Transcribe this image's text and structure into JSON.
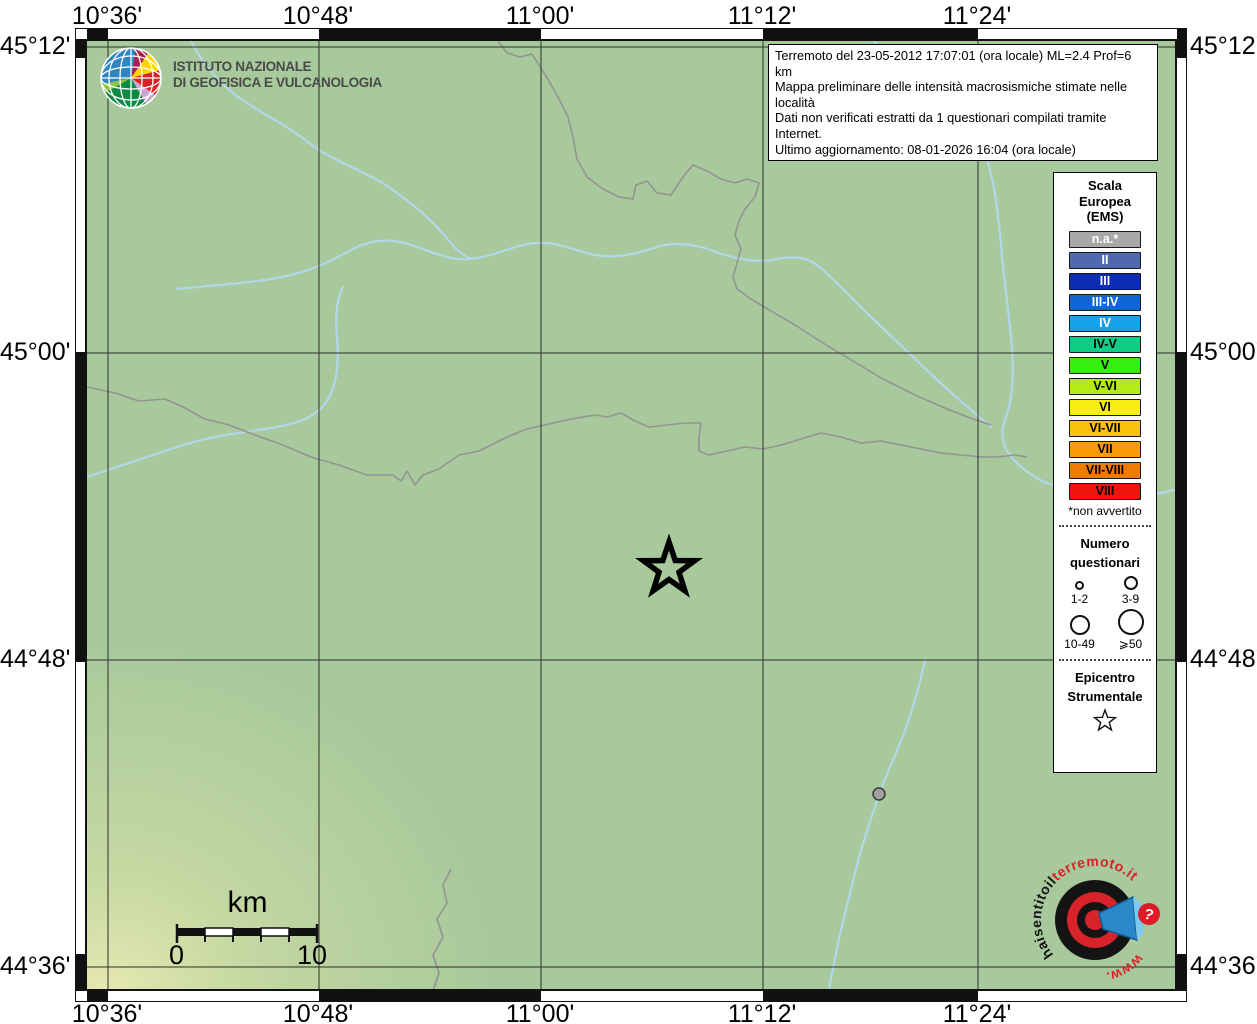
{
  "theme": {
    "map-green": "#a7c99b",
    "river-blue": "#b3d7e9",
    "boundary-gray": "#949494",
    "frame-black": "#111111",
    "band-white": "#ffffff",
    "legend-red": "#d8232a",
    "ingv-blue": "#2e86c1"
  },
  "axes": {
    "lon": [
      "10°36'",
      "10°48'",
      "11°00'",
      "11°12'",
      "11°24'"
    ],
    "lat": [
      "45°12'",
      "45°00'",
      "44°48'",
      "44°36'"
    ]
  },
  "info_box": {
    "line1": "Terremoto del 23-05-2012 17:07:01 (ora locale) ML=2.4 Prof=6 km",
    "line2": "Mappa preliminare delle intensità macrosismiche stimate nelle località",
    "line3": "Dati non verificati estratti da 1 questionari compilati tramite Internet.",
    "line4": "Ultimo aggiornamento: 08-01-2026 16:04 (ora locale)"
  },
  "ingv_logo": {
    "line1": "ISTITUTO NAZIONALE",
    "line2": "DI GEOFISICA E VULCANOLOGIA"
  },
  "legend": {
    "title_line1": "Scala",
    "title_line2": "Europea",
    "title_line3": "(EMS)",
    "ems_classes": [
      {
        "label": "n.a.*",
        "color": "#a8a8a8",
        "text": "#ffffff"
      },
      {
        "label": "II",
        "color": "#4f68b0",
        "text": "#ffffff"
      },
      {
        "label": "III",
        "color": "#0b2db4",
        "text": "#ffffff"
      },
      {
        "label": "III-IV",
        "color": "#0d66d4",
        "text": "#ffffff"
      },
      {
        "label": "IV",
        "color": "#14a3e8",
        "text": "#ffffff"
      },
      {
        "label": "IV-V",
        "color": "#0fcd84",
        "text": "#000000"
      },
      {
        "label": "V",
        "color": "#37f00f",
        "text": "#000000"
      },
      {
        "label": "V-VI",
        "color": "#b6ea16",
        "text": "#000000"
      },
      {
        "label": "VI",
        "color": "#f8ee10",
        "text": "#000000"
      },
      {
        "label": "VI-VII",
        "color": "#f9c20a",
        "text": "#000000"
      },
      {
        "label": "VII",
        "color": "#f99b08",
        "text": "#000000"
      },
      {
        "label": "VII-VIII",
        "color": "#ef7a04",
        "text": "#000000"
      },
      {
        "label": "VIII",
        "color": "#f01310",
        "text": "#000000"
      }
    ],
    "footnote": "*non avvertito",
    "questionnaires": {
      "title_line1": "Numero",
      "title_line2": "questionari",
      "classes": [
        {
          "label": "1-2"
        },
        {
          "label": "3-9"
        },
        {
          "label": "10-49"
        },
        {
          "label": "⩾50"
        }
      ]
    },
    "epicenter": {
      "title_line1": "Epicentro",
      "title_line2": "Strumentale"
    }
  },
  "scale_bar": {
    "unit_label": "km",
    "tick_start": "0",
    "tick_end": "10"
  },
  "hsit_logo": {
    "text_black": "haisentitoil",
    "text_red": "terremoto.it",
    "text_www": "www.",
    "question_mark": "?"
  }
}
